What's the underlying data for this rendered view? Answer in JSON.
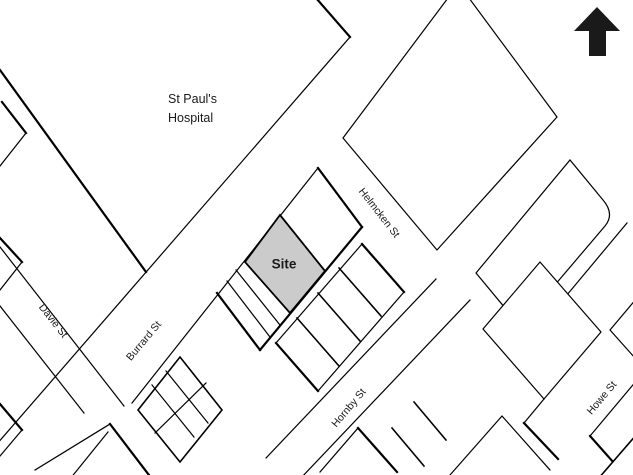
{
  "map": {
    "area": {
      "hospital_line1": "St Paul's",
      "hospital_line2": "Hospital"
    },
    "site": {
      "label": "Site",
      "fill": "#cbcbcb"
    },
    "streets": {
      "burrard": "Burrard St",
      "davie": "Davie St",
      "helmcken": "Helmcken St",
      "hornby": "Hornby St",
      "howe": "Howe St"
    },
    "icons": {
      "north_arrow": "north-arrow"
    },
    "colors": {
      "line": "#000000",
      "background": "#ffffff",
      "arrow": "#1a1a1a"
    }
  }
}
